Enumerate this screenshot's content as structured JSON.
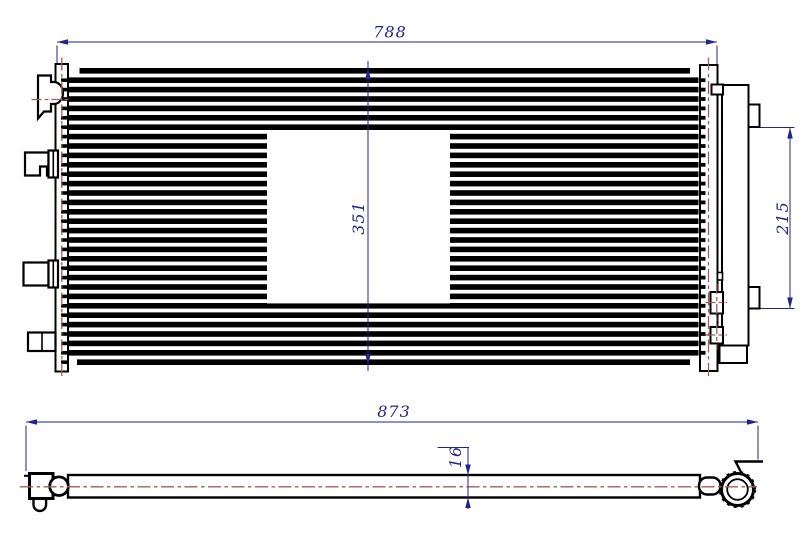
{
  "meta": {
    "type": "technical-drawing",
    "subject": "condenser two-view dimensioned drawing",
    "background": "#ffffff"
  },
  "colors": {
    "outline": "#000000",
    "dimension": "#23238c",
    "centerline": "#a05f5f"
  },
  "dims": {
    "width": "788",
    "height": "351",
    "bracket_span": "215",
    "length": "873",
    "thickness": "16"
  }
}
